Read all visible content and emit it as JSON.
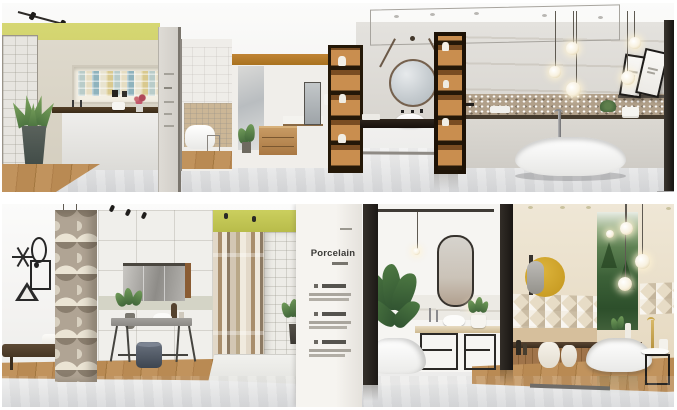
{
  "window": {
    "width": 677,
    "height": 410,
    "background": "#ffffff",
    "kind": "two stacked interior showroom renders"
  },
  "panels": {
    "top": {
      "name": "tile-showroom-render-top",
      "objects": [
        "track-lighting",
        "yellow-accent-wall",
        "white-tile-wall",
        "mosaic-display-niche",
        "display-counter",
        "flower-vase",
        "aloe-plant",
        "signage-column",
        "doorway-bathtub-display",
        "amber-banded-display",
        "wood-drawer-cabinet",
        "wall-mirror",
        "illuminated-shelf-unit",
        "strap-hung-round-mirror",
        "vessel-sink",
        "dark-stone-vanity",
        "marble-feature-wall",
        "sparkle-mosaic-band",
        "pendant-globe-lights",
        "freestanding-bathtub",
        "floor-mounted-faucet",
        "leaning-picture-frames",
        "glossy-marble-floor",
        "wood-plank-floor"
      ]
    },
    "bottom": {
      "name": "tile-showroom-render-bottom",
      "sign": {
        "title": "Porcelain"
      },
      "objects": [
        "wire-wall-art-shapes",
        "patterned-arc-tile-column",
        "upholstered-bench",
        "towel-stack",
        "wood-stool",
        "wide-vanity-mirror",
        "vanity-console-table",
        "round-waste-bin",
        "yellow-accent-band",
        "striped-tile-wall",
        "white-tile-wall",
        "porcelain-sign-column",
        "capsule-mirror",
        "marble-splash-band",
        "metal-frame-stools",
        "banana-leaf-plant",
        "sculpted-bathtub",
        "yellow-circle-mirror",
        "diamond-relief-band",
        "wood-slat-wall",
        "fabric-baskets",
        "forest-mural-panel",
        "pendant-globe-lights",
        "freestanding-bathtub-right",
        "round-side-table",
        "glossy-marble-floor"
      ]
    }
  },
  "palette": {
    "accent_yellow_green_top": "#cfd06c",
    "accent_yellow_green_bottom": "#c3c654",
    "accent_amber_band": "#b5772a",
    "mustard_mirror_disc": "#d0a72c",
    "wood_floor": "#b9894f",
    "dark_wood": "#2a2018",
    "cream_wall": "#e9dfcc",
    "marble_floor": "#dfe0e2",
    "forest_green": "#3a5c38",
    "sign_text": "#3b3a37"
  }
}
